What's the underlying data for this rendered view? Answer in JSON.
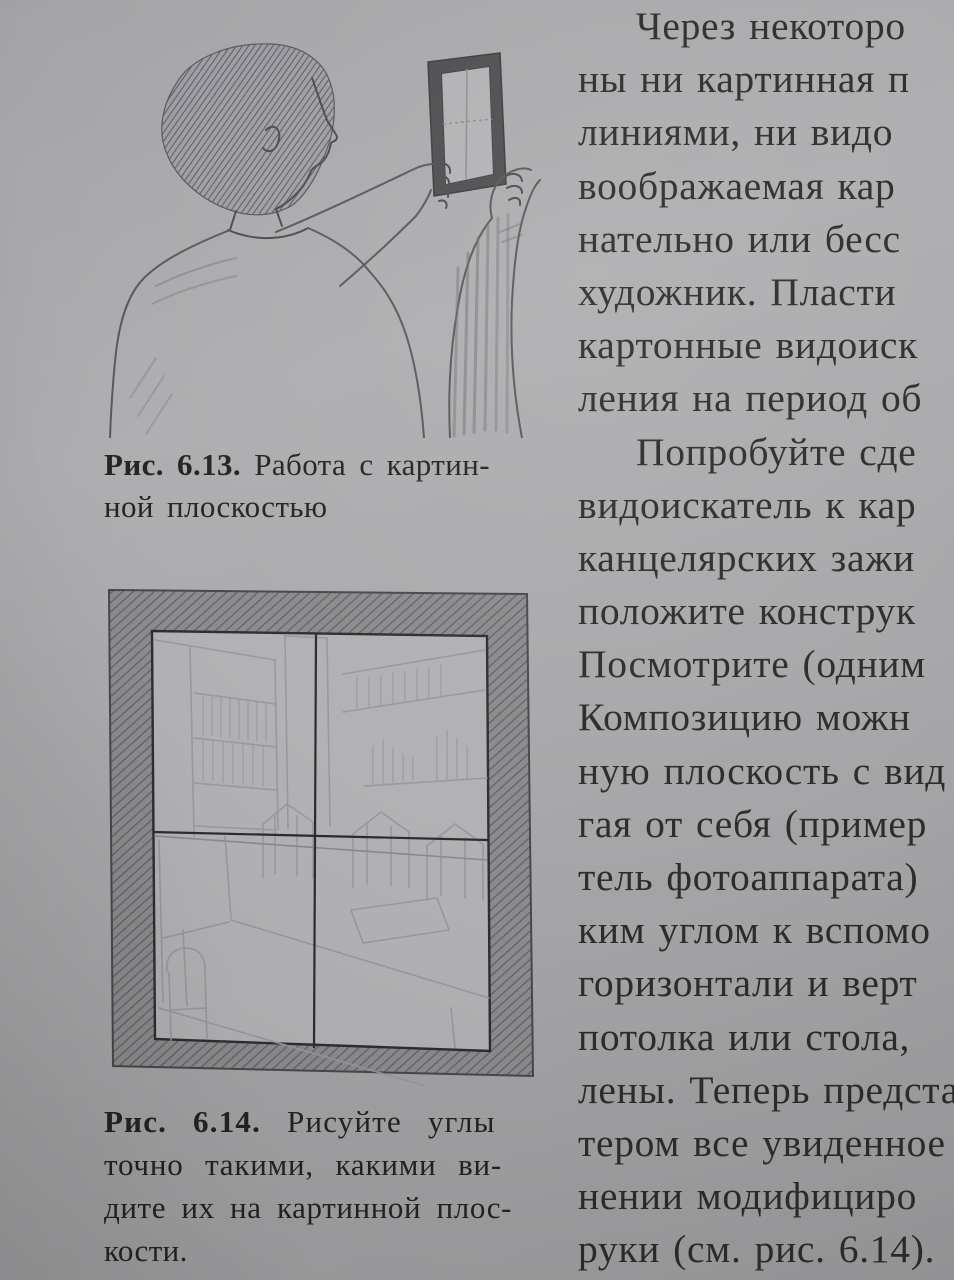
{
  "page": {
    "background_color": "#a7a7a9",
    "text_color": "#2b2a29",
    "kind_note": "photographed book page"
  },
  "figure_6_13": {
    "description": "pencil sketch of a man seen from behind holding a small rectangular viewfinder frame with crosshairs at arm's length",
    "caption": {
      "label": "Рис. 6.13.",
      "line1_rest": "Работа с картин-",
      "line2": "ной плоскостью"
    }
  },
  "figure_6_14": {
    "description": "pencil sketch of a room interior (bookshelves, chairs, table) seen through a dark hatched viewfinder frame with crosshair lines",
    "caption": {
      "label": "Рис. 6.14.",
      "line1_rest": "Рисуйте углы",
      "line2": "точно такими, какими ви-",
      "line3": "дите их на картинной плос-",
      "line4": "кости."
    }
  },
  "right_column": {
    "lines": [
      {
        "t": "Через некоторо",
        "indent": true
      },
      {
        "t": "ны ни картинная п"
      },
      {
        "t": "линиями, ни видо"
      },
      {
        "t": "воображаемая кар"
      },
      {
        "t": "нательно или бесс"
      },
      {
        "t": "художник. Пласти"
      },
      {
        "t": "картонные видоиск"
      },
      {
        "t": "ления на период об"
      },
      {
        "t": "Попробуйте сде",
        "indent": true
      },
      {
        "t": "видоискатель к кар"
      },
      {
        "t": "канцелярских зажи"
      },
      {
        "t": "положите конструк"
      },
      {
        "t": "Посмотрите (одним"
      },
      {
        "t": "Композицию можн"
      },
      {
        "t": "ную плоскость с вид"
      },
      {
        "t": "гая от себя (пример"
      },
      {
        "t": "тель фотоаппарата)"
      },
      {
        "t": "ким углом к вспомо"
      },
      {
        "t": "горизонтали и верт"
      },
      {
        "t": "потолка или стола,"
      },
      {
        "t": "лены. Теперь предста"
      },
      {
        "t": "тером все увиденное"
      },
      {
        "t": "нении модифициро"
      },
      {
        "t": "руки (см. рис. 6.14)."
      }
    ]
  }
}
